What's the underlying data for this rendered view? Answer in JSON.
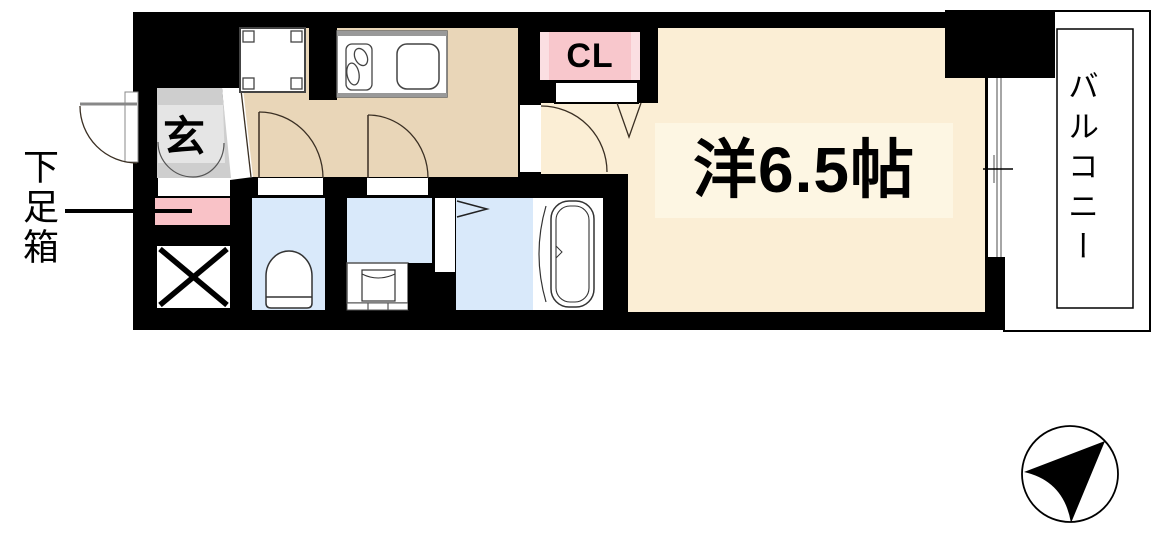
{
  "labels": {
    "entrance": "玄",
    "shoe_box": "下足箱",
    "closet": "CL",
    "main_room": "洋6.5帖",
    "balcony": "バルコニー"
  },
  "colors": {
    "wall": "#000000",
    "hall_floor": "#e9d6b8",
    "room_floor": "#fbeed5",
    "room_label_bg": "#fdf6e3",
    "closet_pink": "#f8c7cc",
    "closet_pink_light": "#fbdfe2",
    "shoebox_pink": "#f9c2c7",
    "wet_area_blue": "#d9e9fa",
    "entrance_gray": "#cecece",
    "entrance_gray_light": "#e5e5e5",
    "fixture_white": "#ffffff",
    "door_arc": "#3a2f23"
  },
  "compass": {
    "type": "north-arrow",
    "points": "upper-right"
  }
}
